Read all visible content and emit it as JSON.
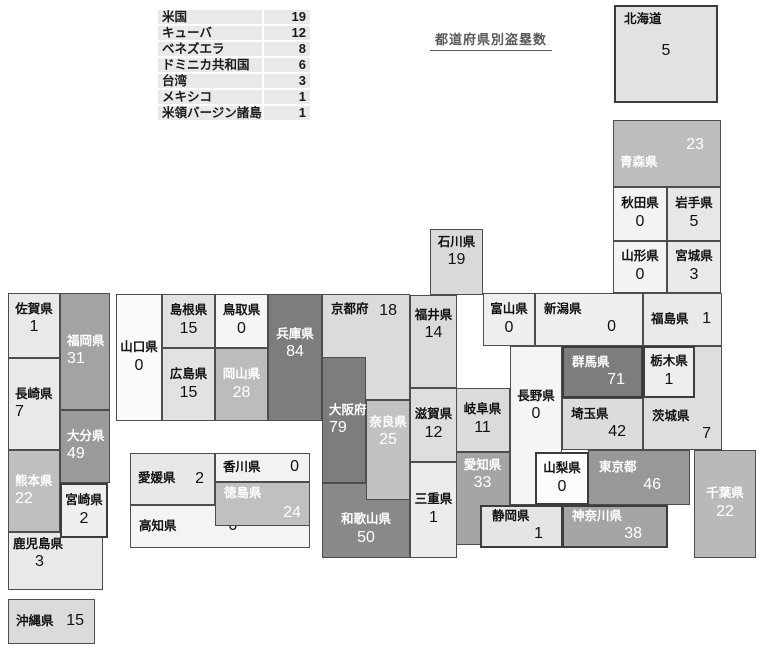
{
  "chart_data": {
    "type": "heatmap",
    "title": "都道府県別盗塁数",
    "legend": "none",
    "foreign_table": {
      "rows": [
        {
          "label": "米国",
          "value": 19
        },
        {
          "label": "キューバ",
          "value": 12
        },
        {
          "label": "ベネズエラ",
          "value": 8
        },
        {
          "label": "ドミニカ共和国",
          "value": 6
        },
        {
          "label": "台湾",
          "value": 3
        },
        {
          "label": "メキシコ",
          "value": 1
        },
        {
          "label": "米領バージン諸島",
          "value": 1
        }
      ]
    },
    "prefectures": [
      {
        "id": "hokkaido",
        "name": "北海道",
        "value": 5,
        "x": 614,
        "y": 5,
        "w": 104,
        "h": 98,
        "bg": "#e2e2e2",
        "fg": "#111111",
        "lay": "hokkaido",
        "thick": true
      },
      {
        "id": "aomori",
        "name": "青森県",
        "value": 23,
        "x": 613,
        "y": 120,
        "w": 108,
        "h": 67,
        "bg": "#bdbdbd",
        "fg": "#ffffff",
        "lay": "vtop"
      },
      {
        "id": "akita",
        "name": "秋田県",
        "value": 0,
        "x": 613,
        "y": 187,
        "w": 54,
        "h": 54,
        "bg": "#f3f3f3",
        "fg": "#111111",
        "lay": "stack"
      },
      {
        "id": "iwate",
        "name": "岩手県",
        "value": 5,
        "x": 667,
        "y": 187,
        "w": 54,
        "h": 54,
        "bg": "#e7e7e7",
        "fg": "#111111",
        "lay": "stack"
      },
      {
        "id": "yamagata",
        "name": "山形県",
        "value": 0,
        "x": 613,
        "y": 241,
        "w": 54,
        "h": 52,
        "bg": "#f3f3f3",
        "fg": "#111111",
        "lay": "stack"
      },
      {
        "id": "miyagi",
        "name": "宮城県",
        "value": 3,
        "x": 667,
        "y": 241,
        "w": 54,
        "h": 52,
        "bg": "#e9e9e9",
        "fg": "#111111",
        "lay": "stack"
      },
      {
        "id": "ishikawa",
        "name": "石川県",
        "value": 19,
        "x": 430,
        "y": 229,
        "w": 53,
        "h": 66,
        "bg": "#dadada",
        "fg": "#111111",
        "lay": "stack-top"
      },
      {
        "id": "toyama",
        "name": "富山県",
        "value": 0,
        "x": 483,
        "y": 293,
        "w": 52,
        "h": 53,
        "bg": "#efefef",
        "fg": "#111111",
        "lay": "stack"
      },
      {
        "id": "niigata",
        "name": "新潟県",
        "value": 0,
        "x": 535,
        "y": 293,
        "w": 108,
        "h": 53,
        "bg": "#efefef",
        "fg": "#111111",
        "lay": "nv-right",
        "pad": "4px 26px 4px 8px"
      },
      {
        "id": "fukushima",
        "name": "福島県",
        "value": 1,
        "x": 643,
        "y": 293,
        "w": 79,
        "h": 53,
        "bg": "#e9e9e9",
        "fg": "#111111",
        "lay": "inline"
      },
      {
        "id": "ibaraki",
        "name": "茨城県",
        "value": 7,
        "x": 643,
        "y": 346,
        "w": 79,
        "h": 104,
        "bg": "#dedede",
        "fg": "#111111",
        "lay": "nv-right-bottom"
      },
      {
        "id": "tochigi",
        "name": "栃木県",
        "value": 1,
        "x": 643,
        "y": 346,
        "w": 52,
        "h": 52,
        "bg": "#ededed",
        "fg": "#111111",
        "lay": "stack",
        "thick": true,
        "z": 2
      },
      {
        "id": "gunma",
        "name": "群馬県",
        "value": 71,
        "x": 562,
        "y": 346,
        "w": 81,
        "h": 52,
        "bg": "#7d7d7d",
        "fg": "#ffffff",
        "lay": "nv-right",
        "thick": true,
        "pad": "3px 16px 3px 8px"
      },
      {
        "id": "nagano",
        "name": "長野県",
        "value": 0,
        "x": 510,
        "y": 346,
        "w": 52,
        "h": 159,
        "bg": "#f5f5f5",
        "fg": "#111111",
        "lay": "stack-top",
        "pad": "42px 2px 0 2px"
      },
      {
        "id": "saitama",
        "name": "埼玉県",
        "value": 42,
        "x": 562,
        "y": 398,
        "w": 81,
        "h": 52,
        "bg": "#dcdcdc",
        "fg": "#111111",
        "lay": "nv-right",
        "pad": "3px 16px 3px 8px"
      },
      {
        "id": "yamanashi",
        "name": "山梨県",
        "value": 0,
        "x": 535,
        "y": 452,
        "w": 54,
        "h": 53,
        "bg": "#fcfcfc",
        "fg": "#111111",
        "lay": "stack",
        "thick": true,
        "z": 3
      },
      {
        "id": "tokyo",
        "name": "東京都",
        "value": 46,
        "x": 588,
        "y": 450,
        "w": 102,
        "h": 55,
        "bg": "#989898",
        "fg": "#ffffff",
        "lay": "nv-right",
        "pad": "5px 28px 5px 10px",
        "z": 2
      },
      {
        "id": "chiba",
        "name": "千葉県",
        "value": 22,
        "x": 694,
        "y": 450,
        "w": 62,
        "h": 108,
        "bg": "#b9b9b9",
        "fg": "#ffffff",
        "lay": "stack"
      },
      {
        "id": "kanagawa",
        "name": "神奈川県",
        "value": 38,
        "x": 562,
        "y": 505,
        "w": 106,
        "h": 43,
        "bg": "#a5a5a5",
        "fg": "#ffffff",
        "lay": "nv-right",
        "thick": true,
        "pad": "2px 24px 2px 8px",
        "z": 3
      },
      {
        "id": "shizuoka",
        "name": "静岡県",
        "value": 1,
        "x": 480,
        "y": 505,
        "w": 83,
        "h": 43,
        "bg": "#e5e5e5",
        "fg": "#111111",
        "lay": "nv-right",
        "thick": true,
        "pad": "2px 18px 2px 10px",
        "z": 3
      },
      {
        "id": "aichi",
        "name": "愛知県",
        "value": 33,
        "x": 455,
        "y": 452,
        "w": 55,
        "h": 93,
        "bg": "#a5a5a5",
        "fg": "#ffffff",
        "lay": "stack-top",
        "pad": "5px 0 0 0"
      },
      {
        "id": "gifu",
        "name": "岐阜県",
        "value": 11,
        "x": 455,
        "y": 388,
        "w": 55,
        "h": 64,
        "bg": "#dbdbdb",
        "fg": "#111111",
        "lay": "stack"
      },
      {
        "id": "shiga",
        "name": "滋賀県",
        "value": 12,
        "x": 410,
        "y": 388,
        "w": 47,
        "h": 74,
        "bg": "#dedede",
        "fg": "#111111",
        "lay": "stack"
      },
      {
        "id": "mie",
        "name": "三重県",
        "value": 1,
        "x": 410,
        "y": 462,
        "w": 47,
        "h": 96,
        "bg": "#ececec",
        "fg": "#111111",
        "lay": "stack"
      },
      {
        "id": "fukui",
        "name": "福井県",
        "value": 14,
        "x": 410,
        "y": 295,
        "w": 47,
        "h": 93,
        "bg": "#dbdbdb",
        "fg": "#111111",
        "lay": "stack-top",
        "pad": "12px 0 0 0"
      },
      {
        "id": "kyoto",
        "name": "京都府",
        "value": 18,
        "x": 322,
        "y": 294,
        "w": 88,
        "h": 106,
        "bg": "#dbdbdb",
        "fg": "#111111",
        "lay": "inline-top"
      },
      {
        "id": "osaka",
        "name": "大阪府",
        "value": 79,
        "x": 322,
        "y": 357,
        "w": 44,
        "h": 126,
        "bg": "#7d7d7d",
        "fg": "#ffffff",
        "lay": "stack-left",
        "z": 2
      },
      {
        "id": "nara",
        "name": "奈良県",
        "value": 25,
        "x": 366,
        "y": 400,
        "w": 44,
        "h": 100,
        "bg": "#c2c2c2",
        "fg": "#ffffff",
        "lay": "stack-top",
        "pad": "14px 0 0 0",
        "z": 2
      },
      {
        "id": "wakayama",
        "name": "和歌山県",
        "value": 50,
        "x": 322,
        "y": 483,
        "w": 88,
        "h": 75,
        "bg": "#898989",
        "fg": "#ffffff",
        "lay": "stack",
        "pad": "18px 0 0 0"
      },
      {
        "id": "hyogo",
        "name": "兵庫県",
        "value": 84,
        "x": 268,
        "y": 294,
        "w": 54,
        "h": 127,
        "bg": "#7d7d7d",
        "fg": "#ffffff",
        "lay": "stack-top",
        "pad": "32px 0 0 0"
      },
      {
        "id": "tottori",
        "name": "鳥取県",
        "value": 0,
        "x": 215,
        "y": 294,
        "w": 53,
        "h": 54,
        "bg": "#f5f5f5",
        "fg": "#111111",
        "lay": "stack"
      },
      {
        "id": "shimane",
        "name": "島根県",
        "value": 15,
        "x": 162,
        "y": 294,
        "w": 53,
        "h": 54,
        "bg": "#e2e2e2",
        "fg": "#111111",
        "lay": "stack"
      },
      {
        "id": "okayama",
        "name": "岡山県",
        "value": 28,
        "x": 215,
        "y": 348,
        "w": 53,
        "h": 73,
        "bg": "#bcbcbc",
        "fg": "#ffffff",
        "lay": "stack"
      },
      {
        "id": "hiroshima",
        "name": "広島県",
        "value": 15,
        "x": 162,
        "y": 348,
        "w": 53,
        "h": 73,
        "bg": "#e2e2e2",
        "fg": "#111111",
        "lay": "stack"
      },
      {
        "id": "yamaguchi",
        "name": "山口県",
        "value": 0,
        "x": 116,
        "y": 294,
        "w": 46,
        "h": 127,
        "bg": "#fafafa",
        "fg": "#111111",
        "lay": "stack"
      },
      {
        "id": "ehime",
        "name": "愛媛県",
        "value": 2,
        "x": 130,
        "y": 453,
        "w": 85,
        "h": 52,
        "bg": "#e8e8e8",
        "fg": "#111111",
        "lay": "inline"
      },
      {
        "id": "kagawa",
        "name": "香川県",
        "value": 0,
        "x": 215,
        "y": 453,
        "w": 95,
        "h": 29,
        "bg": "#f2f2f2",
        "fg": "#111111",
        "lay": "inline"
      },
      {
        "id": "tokushima",
        "name": "徳島県",
        "value": 24,
        "x": 215,
        "y": 482,
        "w": 95,
        "h": 44,
        "bg": "#c0c0c0",
        "fg": "#ffffff",
        "lay": "nv-between",
        "z": 2
      },
      {
        "id": "kochi",
        "name": "高知県",
        "value": 0,
        "x": 130,
        "y": 505,
        "w": 180,
        "h": 43,
        "bg": "#f4f4f4",
        "fg": "#111111",
        "lay": "inline-left"
      },
      {
        "id": "saga",
        "name": "佐賀県",
        "value": 1,
        "x": 8,
        "y": 293,
        "w": 52,
        "h": 65,
        "bg": "#e9e9e9",
        "fg": "#111111",
        "lay": "stack-top",
        "pad": "8px 0 0 0"
      },
      {
        "id": "nagasaki",
        "name": "長崎県",
        "value": 7,
        "x": 8,
        "y": 358,
        "w": 52,
        "h": 92,
        "bg": "#e9e9e9",
        "fg": "#111111",
        "lay": "stack-left"
      },
      {
        "id": "kumamoto",
        "name": "熊本県",
        "value": 22,
        "x": 8,
        "y": 450,
        "w": 52,
        "h": 82,
        "bg": "#bfbfbf",
        "fg": "#ffffff",
        "lay": "stack-left"
      },
      {
        "id": "kagoshima",
        "name": "鹿児島県",
        "value": 3,
        "x": 8,
        "y": 532,
        "w": 95,
        "h": 58,
        "bg": "#e9e9e9",
        "fg": "#111111",
        "lay": "stack-top-left"
      },
      {
        "id": "fukuoka",
        "name": "福岡県",
        "value": 31,
        "x": 60,
        "y": 293,
        "w": 50,
        "h": 117,
        "bg": "#a3a3a3",
        "fg": "#ffffff",
        "lay": "stack-left"
      },
      {
        "id": "oita",
        "name": "大分県",
        "value": 49,
        "x": 60,
        "y": 410,
        "w": 50,
        "h": 73,
        "bg": "#9a9a9a",
        "fg": "#ffffff",
        "lay": "stack-left"
      },
      {
        "id": "miyazaki",
        "name": "宮崎県",
        "value": 2,
        "x": 60,
        "y": 483,
        "w": 48,
        "h": 55,
        "bg": "#efefef",
        "fg": "#111111",
        "lay": "stack",
        "thick": true,
        "z": 3
      },
      {
        "id": "okinawa",
        "name": "沖縄県",
        "value": 15,
        "x": 8,
        "y": 599,
        "w": 87,
        "h": 45,
        "bg": "#dbdbdb",
        "fg": "#111111",
        "lay": "inline"
      }
    ]
  }
}
